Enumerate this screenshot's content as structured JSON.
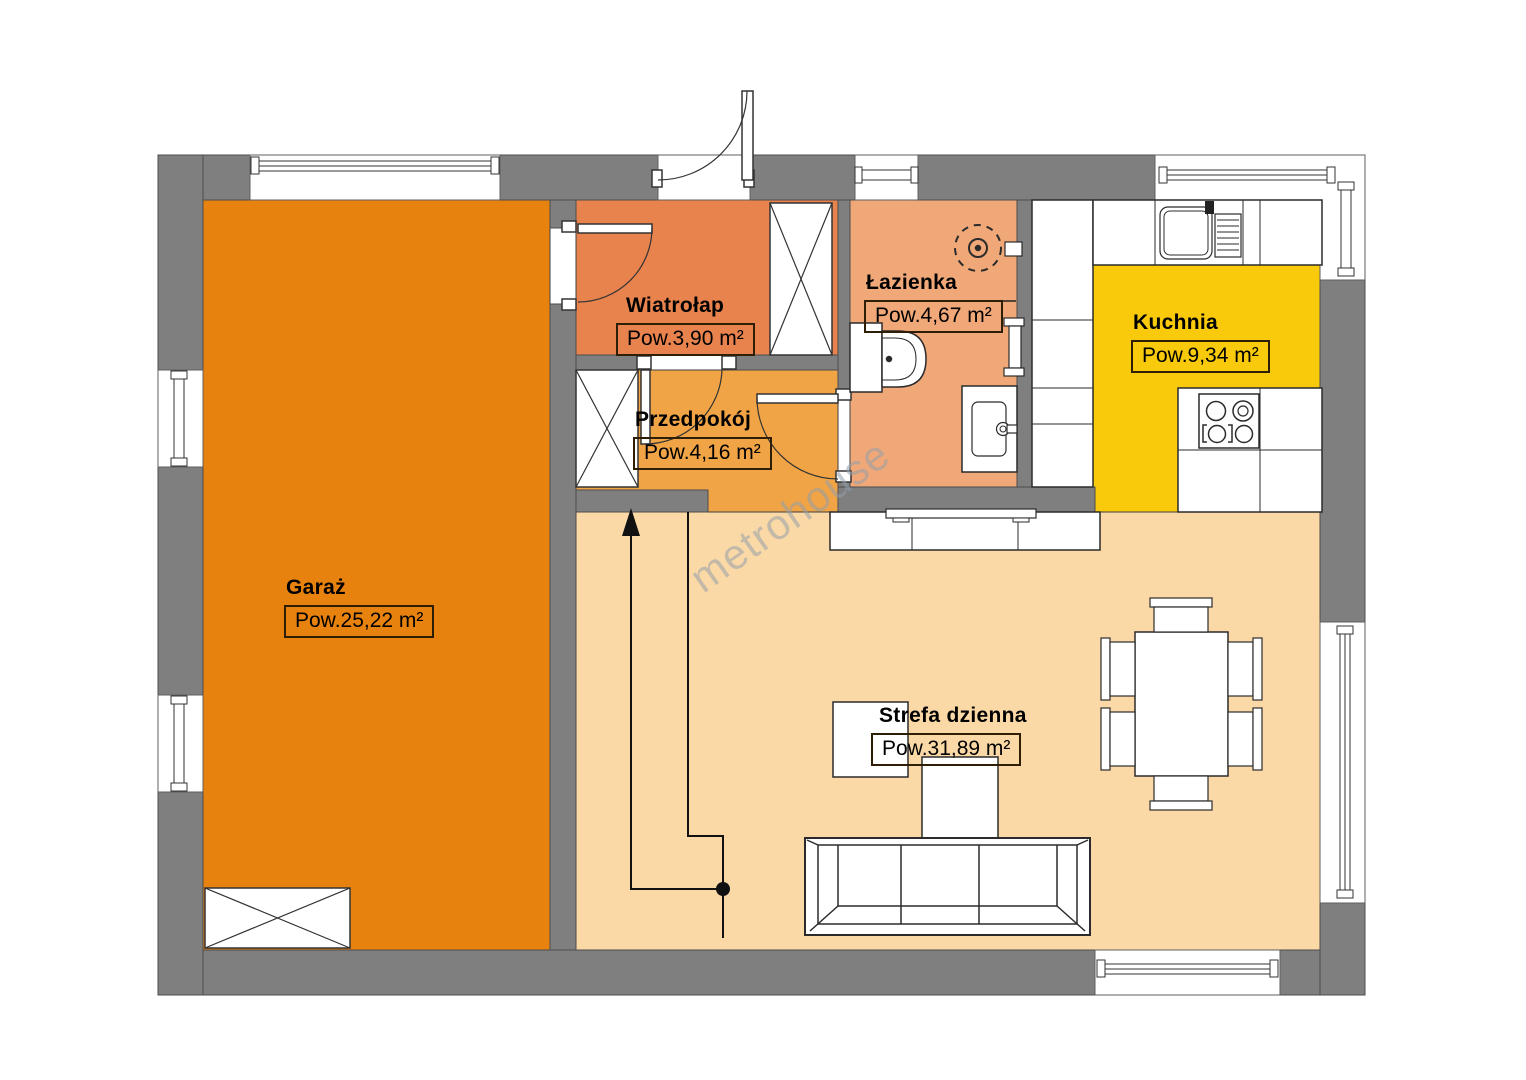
{
  "plan": {
    "watermark": "metrohouse",
    "colors": {
      "wall": "#7f7f7f",
      "garage": "#e8820f",
      "vestibule": "#e8834e",
      "hallway": "#f0a445",
      "bathroom": "#f0a878",
      "kitchen": "#f9ca0b",
      "living": "#fbd9a6"
    },
    "rooms": {
      "garaz": {
        "name": "Garaż",
        "area": "Pow.25,22 m²"
      },
      "wiatrolap": {
        "name": "Wiatrołap",
        "area": "Pow.3,90 m²"
      },
      "przedpokoj": {
        "name": "Przedpokój",
        "area": "Pow.4,16 m²"
      },
      "lazienka": {
        "name": "Łazienka",
        "area": "Pow.4,67 m²"
      },
      "kuchnia": {
        "name": "Kuchnia",
        "area": "Pow.9,34 m²"
      },
      "strefa_dzienna": {
        "name": "Strefa dzienna",
        "area": "Pow.31,89 m²"
      }
    }
  }
}
